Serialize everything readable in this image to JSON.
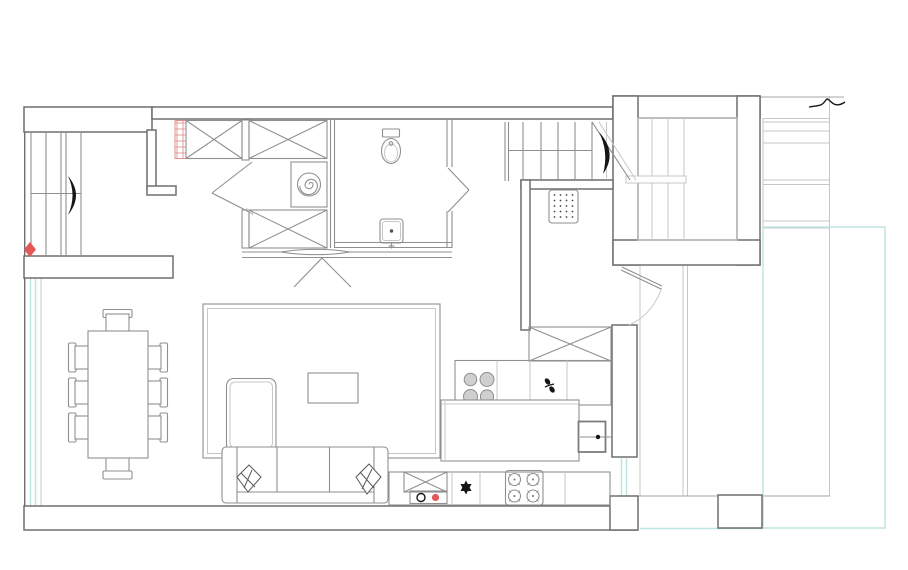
{
  "document": {
    "type": "architectural-floor-plan",
    "visible_text": []
  },
  "colors": {
    "wall": "#6f6f6f",
    "line": "#8f8f8f",
    "light": "#c7c7c7",
    "glass": "#bfe5e2",
    "ink": "#161616",
    "accent": "#e25858",
    "paper": "#ffffff",
    "hatch": "#e08585"
  },
  "plan": {
    "rooms": [
      "entry-stair-hall",
      "closet-hallway",
      "bathroom",
      "laundry-niche",
      "living-room",
      "dining-area",
      "kitchen",
      "upper-stairwell",
      "terrace"
    ],
    "fixtures": [
      "staircase-left-with-direction-arrow",
      "staircase-upper-with-direction-arrow",
      "stairwell-enclosure",
      "entry-floor-grate",
      "wardrobe-crossed-boxes",
      "red-hatched-cabinet-strip",
      "washing-machine-spiral",
      "toilet",
      "washbasin-with-tap",
      "swing-doors",
      "sliding-door-with-caret-mark",
      "dining-table-with-eight-chairs",
      "area-rug",
      "coffee-table",
      "corner-sofa-with-chaise",
      "two-throw-pillows",
      "kitchen-wall-counter",
      "four-zone-cooktop",
      "gas-hob-four-burners",
      "kitchen-island",
      "wall-mounted-sink-box",
      "base-cabinet-with-black-ring-and-red-dot",
      "star-symbol",
      "red-diamond-marker",
      "window-glazing-cyan",
      "terrace-deck-lines",
      "terrace-column",
      "break-line-mark"
    ]
  }
}
